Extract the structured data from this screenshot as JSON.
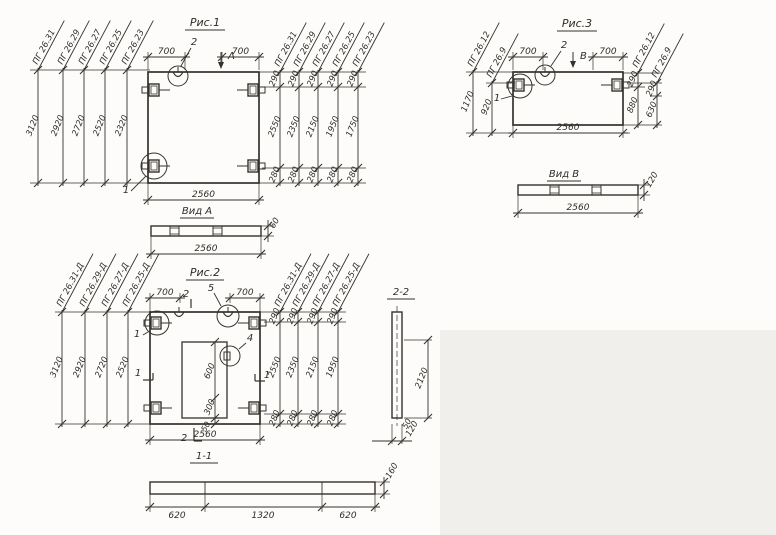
{
  "colors": {
    "ink": "#35322d",
    "paper": "#fdfcfa",
    "scan_shade": "#f0efec"
  },
  "drawing": {
    "fig1": {
      "title": "Рис.1",
      "left_columns": [
        {
          "label": "ПГ 26.31",
          "dim": "3120"
        },
        {
          "label": "ПГ 26.29",
          "dim": "2920"
        },
        {
          "label": "ПГ 26.27",
          "dim": "2720"
        },
        {
          "label": "ПГ 26.25",
          "dim": "2520"
        },
        {
          "label": "ПГ 26.23",
          "dim": "2320"
        }
      ],
      "right_columns": [
        {
          "label": "ПГ 26.31",
          "top": "290",
          "mid": "2550",
          "bottom": "280"
        },
        {
          "label": "ПГ 26.29",
          "top": "290",
          "mid": "2350",
          "bottom": "280"
        },
        {
          "label": "ПГ 26.27",
          "top": "290",
          "mid": "2150",
          "bottom": "280"
        },
        {
          "label": "ПГ 26.25",
          "top": "290",
          "mid": "1950",
          "bottom": "280"
        },
        {
          "label": "ПГ 26.23",
          "top": "290",
          "mid": "1750",
          "bottom": "280"
        }
      ],
      "top_dim_left": "700",
      "top_dim_right": "700",
      "loop_callout": "2",
      "view_arrow": "А",
      "anchor_callout": "1",
      "bottom_dim": "2560"
    },
    "view_a": {
      "title": "Вид А",
      "length": "2560",
      "thickness": "60"
    },
    "fig2": {
      "title": "Рис.2",
      "left_columns": [
        {
          "label": "ПГ 26.31-Д",
          "dim": "3120"
        },
        {
          "label": "ПГ 26.29-Д",
          "dim": "2920"
        },
        {
          "label": "ПГ 26.27-Д",
          "dim": "2720"
        },
        {
          "label": "ПГ 26.25-Д",
          "dim": "2520"
        }
      ],
      "right_columns": [
        {
          "label": "ПГ 26.31-Д",
          "top": "290",
          "mid": "2550",
          "bottom": "280"
        },
        {
          "label": "ПГ 26.29-Д",
          "top": "290",
          "mid": "2350",
          "bottom": "280"
        },
        {
          "label": "ПГ 26.27-Д",
          "top": "290",
          "mid": "2150",
          "bottom": "280"
        },
        {
          "label": "ПГ 26.25-Д",
          "top": "290",
          "mid": "1950",
          "bottom": "280"
        }
      ],
      "top_dim_left": "700",
      "top_dim_right": "700",
      "section_vertical_mark": "2",
      "section_horizontal_mark": "1",
      "loop_callout": "5",
      "anchor_callout": "1",
      "opening_callout": "4",
      "opening_dims": {
        "height": "600",
        "lower": "300",
        "offset": "50"
      },
      "bottom_dim": "2560"
    },
    "fig3": {
      "title": "Рис.3",
      "left_columns": [
        {
          "label": "ПГ 26.12",
          "dim": "1170"
        },
        {
          "label": "ПГ 26.9",
          "dim": "920"
        }
      ],
      "right_columns": [
        {
          "label": "ПГ 26.12",
          "top": "290",
          "mid": "880"
        },
        {
          "label": "ПГ 26.9",
          "top": "290",
          "mid": "630"
        }
      ],
      "top_dim_left": "700",
      "top_dim_right": "700",
      "loop_callout": "2",
      "view_arrow": "В",
      "anchor_callout": "1",
      "bottom_dim": "2560"
    },
    "view_b": {
      "title": "Вид В",
      "length": "2560",
      "thickness": "120"
    },
    "section_1_1": {
      "title": "1-1",
      "segments": [
        "620",
        "1320",
        "620"
      ],
      "height": "160"
    },
    "section_2_2": {
      "title": "2-2",
      "height": "2120",
      "offset": "50",
      "width": "120"
    }
  }
}
